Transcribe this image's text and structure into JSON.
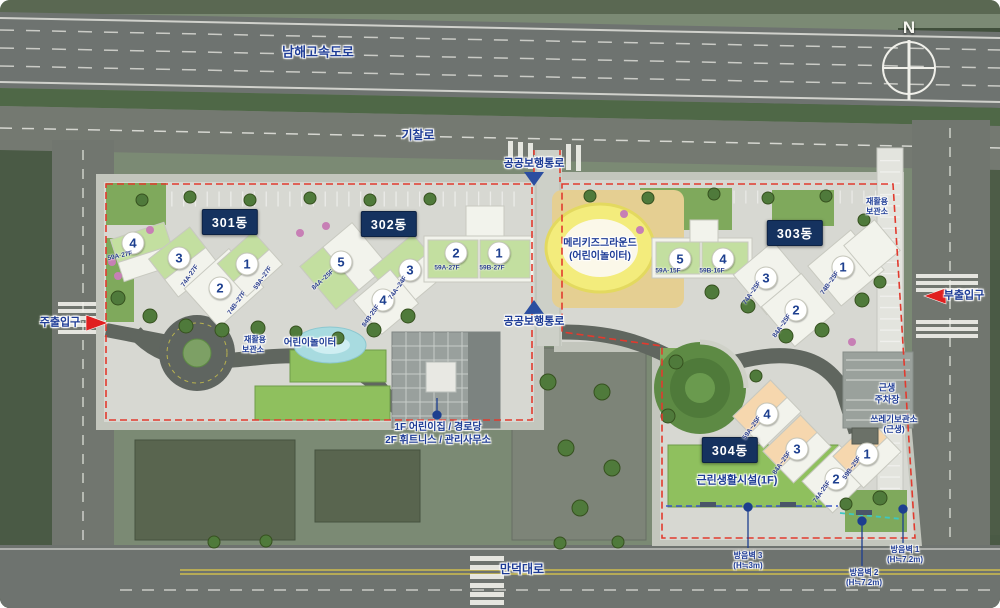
{
  "compass": {
    "north": "N"
  },
  "roads": {
    "highway": "남해고속도로",
    "gichal": "기찰로",
    "manduk": "만덕대로",
    "public_path": "공공보행통로"
  },
  "entrances": {
    "main": "주출입구",
    "sub": "부출입구"
  },
  "buildings": [
    {
      "id": "301동",
      "units": [
        {
          "no": "4",
          "type": "59A·27F"
        },
        {
          "no": "3",
          "type": "74A·27F"
        },
        {
          "no": "2",
          "type": "74B~27F"
        },
        {
          "no": "1",
          "type": "59A~27F"
        }
      ]
    },
    {
      "id": "302동",
      "units": [
        {
          "no": "5",
          "type": "84A~25F"
        },
        {
          "no": "3",
          "type": "74A~24F"
        },
        {
          "no": "4",
          "type": "84B·25F"
        },
        {
          "no": "2",
          "type": "59A·27F"
        },
        {
          "no": "1",
          "type": "59B·27F"
        }
      ]
    },
    {
      "id": "303동",
      "units": [
        {
          "no": "5",
          "type": "59A·15F"
        },
        {
          "no": "4",
          "type": "59B·16F"
        },
        {
          "no": "3",
          "type": "74A~25F"
        },
        {
          "no": "2",
          "type": "84A~25F"
        },
        {
          "no": "1",
          "type": "74B~25F"
        }
      ]
    },
    {
      "id": "304동",
      "units": [
        {
          "no": "4",
          "type": "59A~25F"
        },
        {
          "no": "3",
          "type": "84A~25F"
        },
        {
          "no": "2",
          "type": "74A·25F"
        },
        {
          "no": "1",
          "type": "59B~25F"
        }
      ]
    }
  ],
  "facilities": {
    "merry_kids_line1": "메리키즈그라운드",
    "merry_kids_line2": "(어린이놀이터)",
    "playground": "어린이놀이터",
    "recycle_line1": "재활용",
    "recycle_line2": "보관소",
    "recycle_right_line1": "재활용",
    "recycle_right_line2": "보관소",
    "daycare_line1": "1F 어린이집 / 경로당",
    "daycare_line2": "2F 휘트니스 / 관리사무소",
    "neighborhood": "근린생활시설(1F)",
    "parking_line1": "근생",
    "parking_line2": "주차장",
    "trash_line1": "쓰레기보관소",
    "trash_line2": "(근생)"
  },
  "soundwalls": [
    {
      "name": "방음벽 3",
      "height": "(H≒3m)"
    },
    {
      "name": "방음벽 2",
      "height": "(H≒7.2m)"
    },
    {
      "name": "방음벽 1",
      "height": "(H≒7.2m)"
    }
  ],
  "colors": {
    "boundary_red": "#e23a2e",
    "label_navy": "#1e3c96",
    "badge_bg": "#15325f",
    "green_roof": "#c3dfa0",
    "peach_roof": "#f6d7ae"
  }
}
